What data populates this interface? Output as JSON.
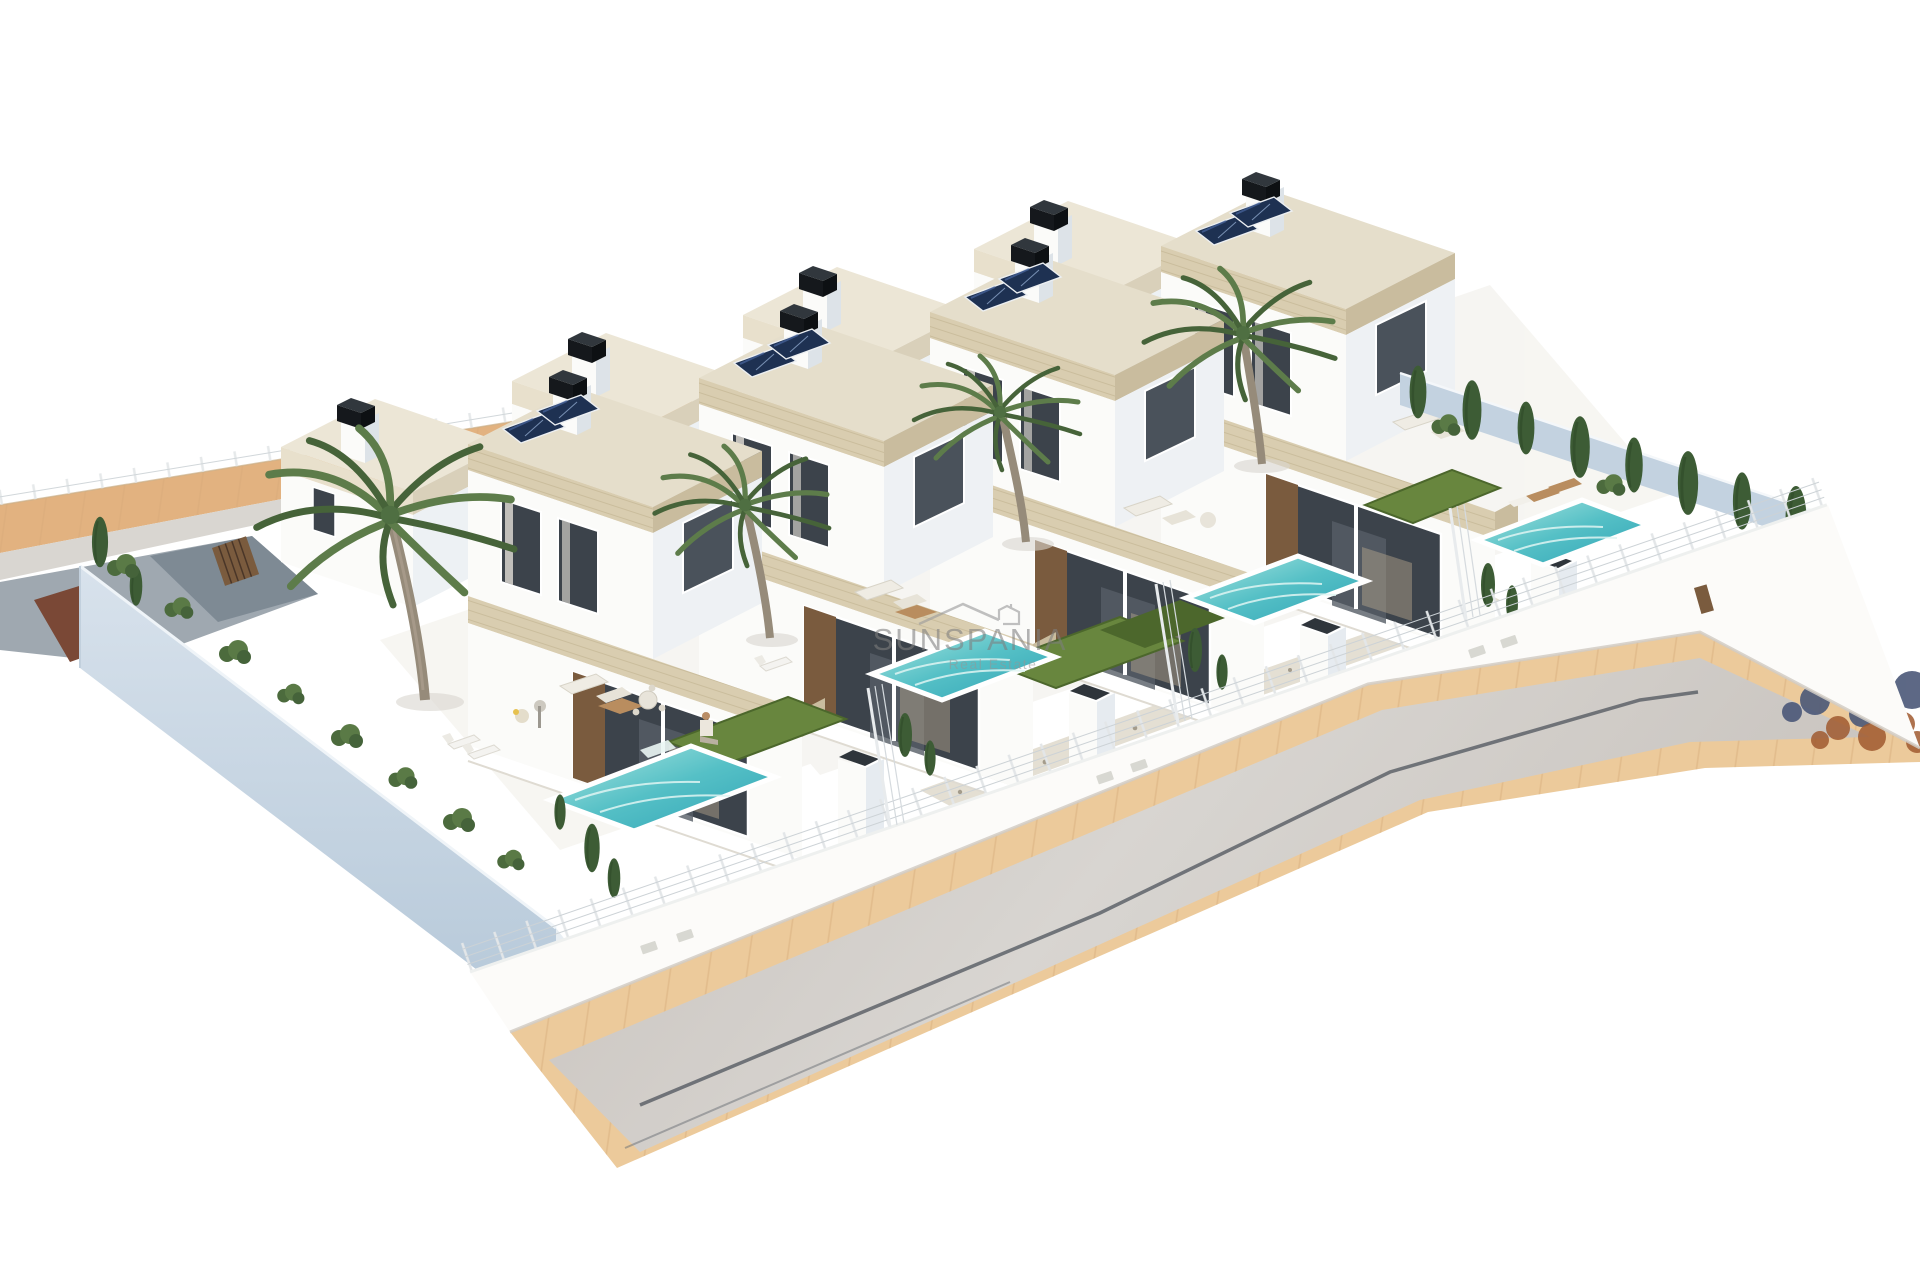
{
  "watermark": {
    "title": "SUNSPANIA",
    "subtitle": "Real Estate",
    "logo_icon": "house-roof-icon"
  },
  "scene": {
    "type": "architectural-3d-render",
    "villa_count": 4,
    "pool_count": 4,
    "visible_features": [
      "solar-panels",
      "black-chimneys",
      "palm-trees",
      "private-pools",
      "lawns",
      "white-mesh-fences",
      "perimeter-walls",
      "asphalt-road",
      "sand-sidewalks",
      "outdoor-furniture",
      "cypress-shrubs"
    ]
  },
  "colors": {
    "background": "#ffffff",
    "sandRoad": "#ecca9b",
    "sandStrip": "#e2b280",
    "asphalt": "#cbc6c1",
    "asphaltLight": "#dcd9d5",
    "curb": "#d9d6d1",
    "driveway": "#9fa8b0",
    "drivewayDark": "#78858f",
    "dirt": "#7a4836",
    "wallShadow": "#c3d2e0",
    "wallShadowLight": "#d8e2ec",
    "whiteWall": "#fbfbf9",
    "fascia": "#d9cdb0",
    "fasciaSide": "#c9bc9e",
    "roof": "#e5decb",
    "roofBack": "#ece6d6",
    "solar": "#1e3152",
    "solarLight": "#49679f",
    "glass": "#3c434b",
    "glassLight": "#4a525b",
    "poolDeep": "#2fa3b5",
    "poolLight": "#a5e3de",
    "lawn": "#68863e",
    "lawnDark": "#4c672c",
    "cypress": "#3d5c35",
    "palm": "#5d7c4a",
    "palmDark": "#466339",
    "trunk": "#968b7a",
    "chimney": "#15181c",
    "chimneyTop": "#31373d",
    "wire": "#ccd2d6",
    "gutter": "#565b63",
    "gravel": "#e4dfd3",
    "gravelDot": "#a49c8c",
    "wood": "#7a5b3e",
    "woodLight": "#b98d5f",
    "silhouetteBlue": "#4b5878",
    "silhouetteRust": "#a05a30",
    "softShadow": "#d9d6ce",
    "watermark": "#8c8c8c"
  }
}
